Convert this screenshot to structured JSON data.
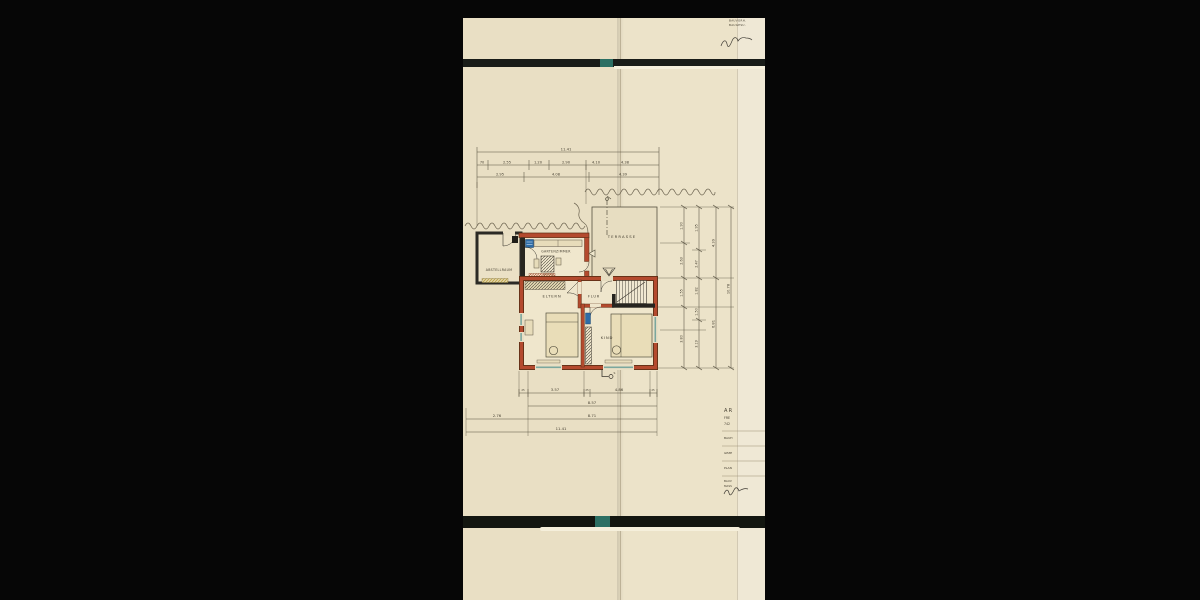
{
  "header": {
    "line1": "BAUVORH.",
    "line2": "BAUGESU."
  },
  "rooms": {
    "terrasse": "TERRASSE",
    "abstellraum": "ABSTELLRAUM",
    "gartenzimmer": "GARTENZIMMER",
    "eltern": "ELTERN",
    "flur": "FLUR",
    "kind": "KIND"
  },
  "dims_top": {
    "total": "11.41",
    "row2": [
      "70",
      "2.55",
      "1.20",
      "2.90",
      "4.10",
      "4.38"
    ],
    "row3": [
      "2.95",
      "4.08",
      "4.39"
    ]
  },
  "dims_bottom": {
    "row1": [
      "25",
      "3.57",
      "25",
      "4.86",
      "25"
    ],
    "row2": "8.57",
    "row3": [
      "2.76",
      "8.71"
    ],
    "total": "11.41"
  },
  "dims_right": {
    "chain1": [
      "1.90",
      "2.63",
      "1.55",
      "3.80"
    ],
    "chain2": [
      "1.95",
      "2.47",
      "1.82",
      "1.50",
      "3.19"
    ],
    "chain3": [
      "4.39",
      "6.81"
    ],
    "chain4": [
      "10.78"
    ]
  },
  "markers": {
    "section": "S"
  },
  "titleblock": {
    "line1": "AR",
    "line2": "FRE",
    "line3": "742",
    "field1": "BAUH",
    "field2": "GEZE",
    "field3": "PLAN",
    "field4": "BAUV",
    "field5": "MASS"
  },
  "colors": {
    "wall_red": "#b44a2e",
    "wall_black": "#2b2a25",
    "paper": "#e9dfc4",
    "teal_tape": "#2c6f63",
    "fixture_blue": "#2e6ca6",
    "hatch_yellow": "#c8a93e"
  }
}
